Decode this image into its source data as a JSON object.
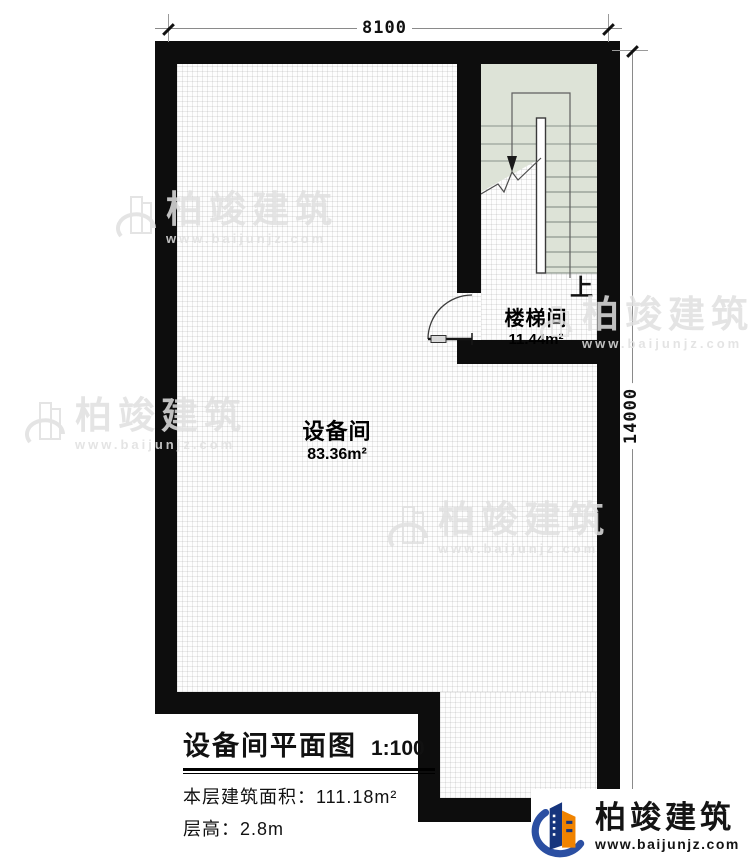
{
  "dimensions": {
    "top": "8100",
    "right": "14000"
  },
  "rooms": [
    {
      "name": "设备间",
      "area": "83.36m²"
    },
    {
      "name": "楼梯间",
      "area": "11.44m²"
    }
  ],
  "stairs": {
    "direction_label": "上"
  },
  "title_block": {
    "title": "设备间平面图",
    "scale": "1:100",
    "area_label": "本层建筑面积：",
    "area_value": "111.18m²",
    "height_label": "层高：",
    "height_value": "2.8m"
  },
  "watermark": {
    "brand": "柏竣建筑",
    "url": "www.baijunjz.com"
  },
  "logo": {
    "brand": "柏竣建筑",
    "url": "www.baijunjz.com"
  },
  "colors": {
    "wall": "#0d0d0d",
    "stair_fill": "#dde3d7",
    "logo_blue": "#2b4fa2",
    "logo_navy": "#16357d",
    "logo_orange": "#f08300",
    "watermark_gray": "#e0e0e0"
  }
}
